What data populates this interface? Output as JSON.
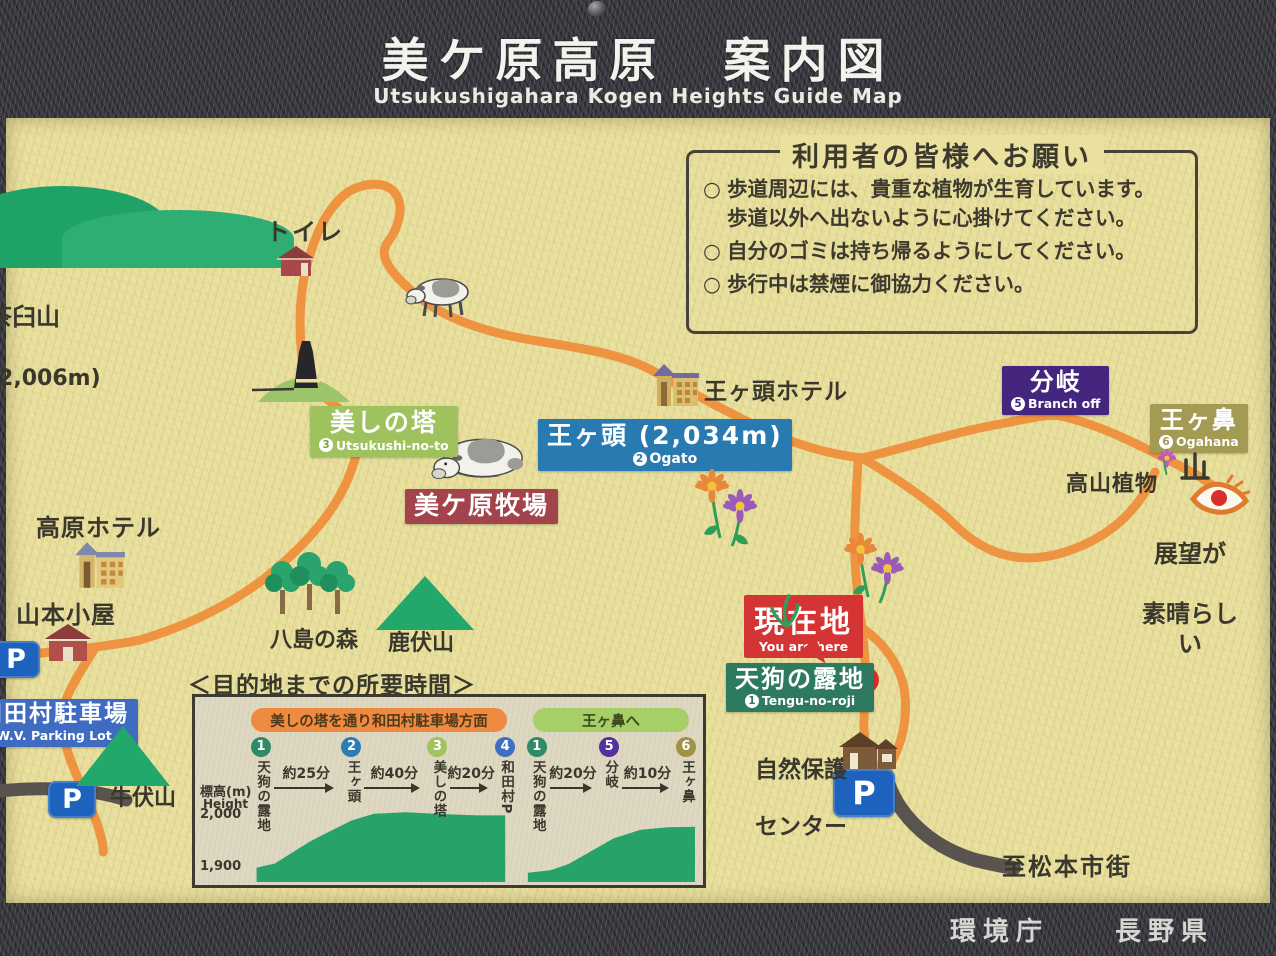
{
  "header": {
    "title": "美ケ原高原　案内図",
    "subtitle": "Utsukushigahara Kogen Heights Guide Map"
  },
  "footer": {
    "credit": "環境庁　　長野県"
  },
  "notice": {
    "title": "利用者の皆様へお願い",
    "bullet": "○",
    "items": [
      [
        "歩道周辺には、貴重な植物が生育しています。",
        "歩道以外へ出ないように心掛けてください。"
      ],
      [
        "自分のゴミは持ち帰るようにしてください。"
      ],
      [
        "歩行中は禁煙に御協力ください。"
      ]
    ]
  },
  "map": {
    "labels": {
      "chausu": {
        "name": "茶臼山",
        "elev": "(2,006m)"
      },
      "toilet": "トイレ",
      "tower": {
        "jp": "美しの塔",
        "num": "3",
        "en": "Utsukushi-no-to"
      },
      "ogato": {
        "jp": "王ヶ頭 (2,034m)",
        "num": "2",
        "en": "Ogato"
      },
      "ogato_hotel": "王ヶ頭ホテル",
      "bokujo": "美ケ原牧場",
      "kogen_hotel": "高原ホテル",
      "yamamoto": "山本小屋",
      "yashima": "八島の森",
      "shikafushi": "鹿伏山",
      "branch": {
        "jp": "分岐",
        "num": "5",
        "en": "Branch off"
      },
      "ogahana": {
        "jp": "王ヶ鼻",
        "num": "6",
        "en": "Ogahana"
      },
      "kozan_plants": "高山植物",
      "tenbo": {
        "line1": "展望が",
        "line2": "素晴らしい"
      },
      "genzaichi": {
        "jp": "現在地",
        "en": "You are here"
      },
      "tengu": {
        "jp": "天狗の露地",
        "num": "1",
        "en": "Tengu-no-roji"
      },
      "shizen": {
        "line1": "自然保護",
        "line2": "センター"
      },
      "matsumoto": "至松本市街",
      "ushifushi": "牛伏山",
      "wada": {
        "jp": "和田村駐車場",
        "en": "W.V. Parking Lot"
      },
      "parking": "P"
    }
  },
  "icons": {
    "toilet": "house-icon",
    "parking": "parking-badge",
    "viewpoint": "eye-icon",
    "cow": "cow-icon",
    "flowers": "flower-icon",
    "tower": "bell-tower-icon",
    "mountains": "mountain-icon",
    "forest": "forest-icon",
    "hotel": "building-icon",
    "bolt": "bolt-icon"
  },
  "colors": {
    "trail_orange": "#ee9340",
    "road_gray": "#5a5450",
    "sign_yellow": "#eae19f",
    "frame_gray": "#393940",
    "forest_green": "#27a269",
    "parking_blue": "#1d62bd",
    "current_red": "#d53434",
    "branch_purple": "#44267e",
    "ogahana_olive": "#a39a54",
    "ogato_blue": "#2a7ab2",
    "tower_green": "#9fc25e",
    "bokujo_maroon": "#a3444c",
    "tengu_green": "#2e7a61"
  },
  "chart_data": {
    "type": "area",
    "title": "＜目的地までの所要時間＞",
    "ylabel_jp": "標高(m)",
    "ylabel_en": "Height",
    "yticks": [
      "2,000",
      "1,900"
    ],
    "ylim": [
      1870,
      2030
    ],
    "routes": [
      {
        "header": "美しの塔を通り和田村駐車場方面",
        "header_color": "#ee8b40",
        "stops": [
          {
            "n": "1",
            "label": "天狗の露地",
            "color": "#2f8a68"
          },
          {
            "n": "2",
            "label": "王ヶ頭",
            "color": "#2e7cb4"
          },
          {
            "n": "3",
            "label": "美しの塔",
            "color": "#a2c35c"
          },
          {
            "n": "4",
            "label": "和田村P",
            "color": "#3f6ec2"
          }
        ],
        "durations": [
          "約25分",
          "約40分",
          "約20分"
        ]
      },
      {
        "header": "王ヶ鼻へ",
        "header_color": "#a7cf68",
        "stops": [
          {
            "n": "1",
            "label": "天狗の露地",
            "color": "#2f8a68"
          },
          {
            "n": "5",
            "label": "分岐",
            "color": "#55309a"
          },
          {
            "n": "6",
            "label": "王ヶ鼻",
            "color": "#a09244"
          }
        ],
        "durations": [
          "約20分",
          "約10分"
        ]
      }
    ],
    "stop_positions_pct": [
      4,
      24,
      43,
      58,
      65,
      81,
      98
    ],
    "profiles": [
      {
        "points_x": [
          3,
          3,
          7,
          11,
          15,
          19,
          24,
          29,
          36,
          45,
          52,
          58,
          58
        ],
        "points_elev": [
          1870,
          1898,
          1906,
          1928,
          1950,
          1968,
          1990,
          2003,
          2006,
          2002,
          2000,
          2000,
          1870
        ]
      },
      {
        "points_x": [
          63,
          63,
          68,
          72,
          77,
          82,
          88,
          94,
          100,
          100
        ],
        "points_elev": [
          1870,
          1888,
          1893,
          1905,
          1930,
          1955,
          1972,
          1977,
          1978,
          1870
        ]
      }
    ]
  }
}
